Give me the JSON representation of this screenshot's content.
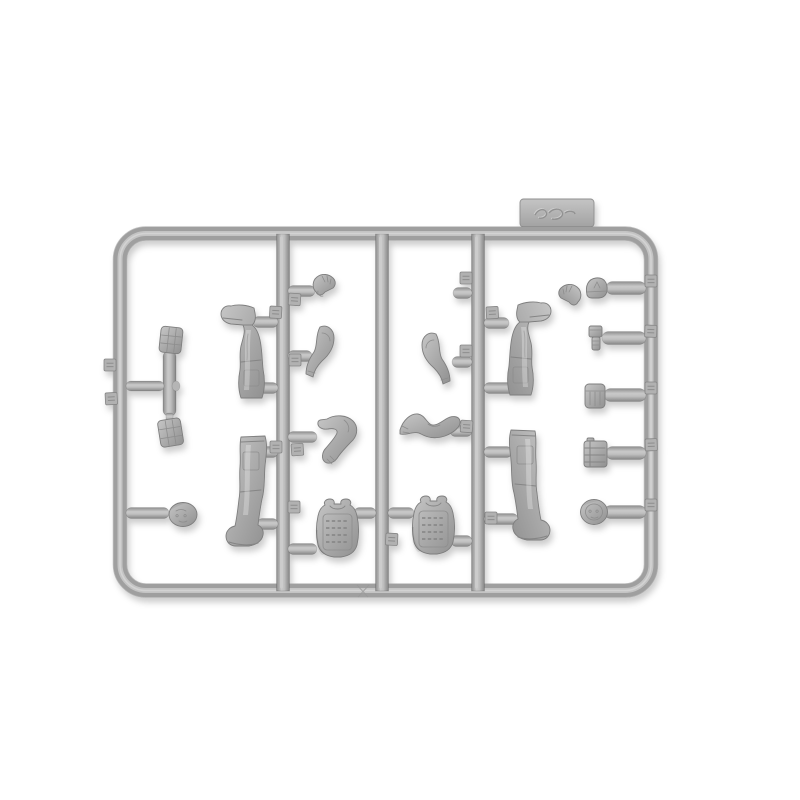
{
  "meta": {
    "description": "Product photo of one gray injection-molded plastic sprue (parts tree) from a military figure model kit, lying on a plain white background",
    "alt": "Gray plastic model-kit sprue containing figure legs with boots, bent arms, gloved hands, two tactical vests, two heads, a helmet and equipment pouches, all attached to a rectangular runner frame"
  },
  "colors": {
    "background": "#ffffff",
    "plastic_base": "#a9a9a9",
    "plastic_light": "#cccccc",
    "plastic_dark": "#868686",
    "edge_line": "#7e7e7e",
    "shadow": "rgba(0,0,0,0.22)"
  },
  "sprue": {
    "brand_tab_label": "embossed manufacturer logo (illegible script)",
    "frame_label": "rectangular sprue frame with three vertical runners",
    "gate_label": "sprue gate",
    "tag_label": "molded part-number tag",
    "part_count": 20,
    "parts": [
      {
        "id": "pouch-top-left",
        "label": "equipment pouch"
      },
      {
        "id": "pouch-bottom-left",
        "label": "equipment pouch"
      },
      {
        "id": "head-left",
        "label": "figure head"
      },
      {
        "id": "leg-upper-left",
        "label": "left leg with boot (inverted)"
      },
      {
        "id": "leg-lower-left",
        "label": "left leg with boot"
      },
      {
        "id": "glove-left",
        "label": "gloved hand"
      },
      {
        "id": "arm-curved-left",
        "label": "bent arm"
      },
      {
        "id": "arm-elbow-left",
        "label": "arm bent at elbow with gloved hand"
      },
      {
        "id": "vest-left",
        "label": "tactical vest / plate carrier"
      },
      {
        "id": "glove-right",
        "label": "gloved hand"
      },
      {
        "id": "arm-curved-right",
        "label": "bent arm"
      },
      {
        "id": "forearms-right",
        "label": "pair of joined forearms"
      },
      {
        "id": "vest-right",
        "label": "tactical vest / plate carrier"
      },
      {
        "id": "leg-upper-right",
        "label": "right leg with boot (inverted)"
      },
      {
        "id": "leg-lower-right",
        "label": "right leg with boot"
      },
      {
        "id": "helmet-right",
        "label": "helmet"
      },
      {
        "id": "flashlight-right",
        "label": "small equipment item"
      },
      {
        "id": "pouch-right",
        "label": "utility pouch"
      },
      {
        "id": "radio-right",
        "label": "radio pouch with straps"
      },
      {
        "id": "head-right",
        "label": "figure head"
      }
    ]
  }
}
